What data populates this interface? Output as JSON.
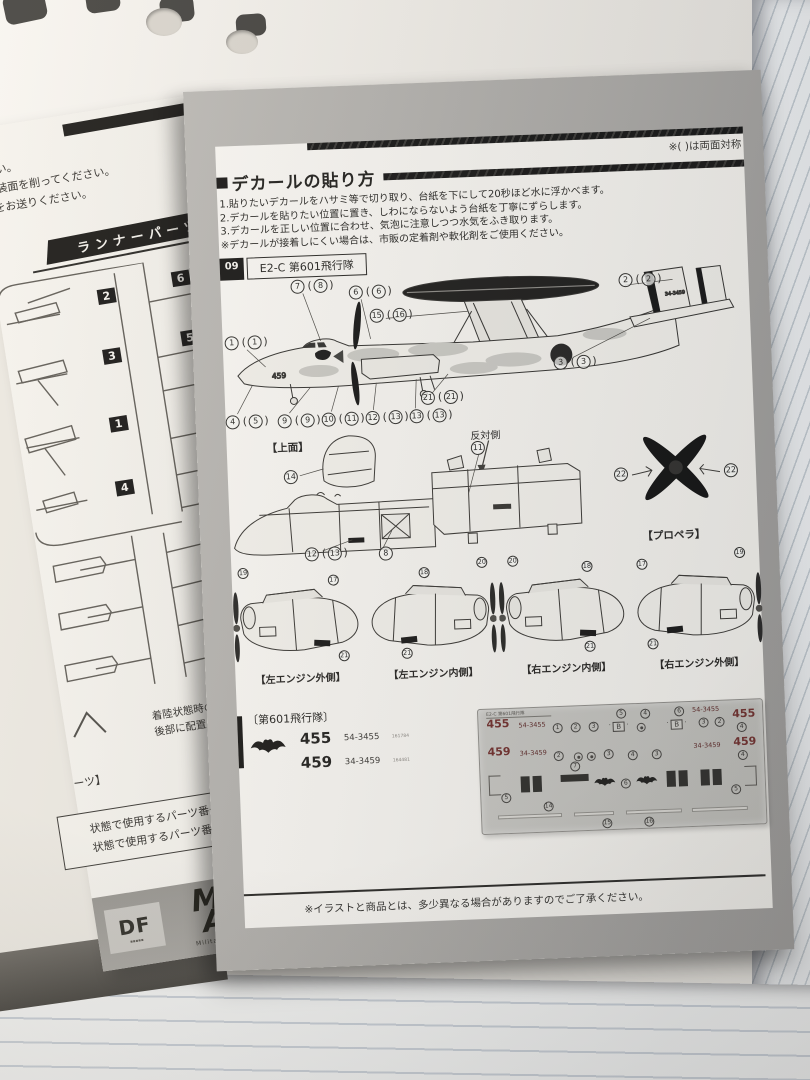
{
  "left_page": {
    "fragment_lines": [
      "さい。",
      "塗装面を削ってください。",
      "をお送りください。"
    ],
    "runner_header": "ランナーパーツ",
    "sprue1_tags": [
      "2",
      "6",
      "3",
      "5",
      "1",
      "4"
    ],
    "size_large": "大",
    "size_small": "小",
    "sprue2_tags": [
      "7",
      "8",
      "9",
      "10"
    ],
    "support_note": "着陸状態時の補助台座です。胴体後部に配置してください。",
    "partial_bracket": "ーツ】",
    "usage_lines": [
      "状態で使用するパーツ番号",
      "状態で使用するパーツ番号"
    ],
    "logos": {
      "partial": "DF",
      "mas_top": "M",
      "mas_bottom": "AS",
      "mas_sub": "Military Aircraft Series"
    }
  },
  "page": {
    "symmetry_note": "※( )は両面対称",
    "header": {
      "title": "デカールの貼り方"
    },
    "instructions": [
      "1.貼りたいデカールをハサミ等で切り取り、台紙を下にして20秒ほど水に浮かべます。",
      "2.デカールを貼りたい位置に置き、しわにならないよう台紙を丁寧にずらします。",
      "3.デカールを正しい位置に合わせ、気泡に注意しつつ水気をふき取ります。",
      "※デカールが接着しにくい場合は、市販の定着剤や軟化剤をご使用ください。"
    ],
    "variant": {
      "number": "09",
      "name": "E2-C 第601飛行隊"
    },
    "side_view": {
      "tail_code": "34-3459",
      "nose_code": "459",
      "callouts": {
        "c7": {
          "n": "7",
          "m": "8"
        },
        "c6": {
          "n": "6",
          "m": "6"
        },
        "c1": {
          "n": "1",
          "m": "1"
        },
        "c15": {
          "n": "15",
          "m": "16"
        },
        "c2": {
          "n": "2",
          "m": "2"
        },
        "c3": {
          "n": "3",
          "m": "3"
        },
        "c21": {
          "n": "21",
          "m": "21"
        },
        "c4": {
          "n": "4",
          "m": "5"
        },
        "c9": {
          "n": "9",
          "m": "9"
        },
        "c10": {
          "n": "10",
          "m": "11"
        },
        "c12": {
          "n": "12",
          "m": "13"
        },
        "c13": {
          "n": "13",
          "m": "13"
        }
      }
    },
    "top_view": {
      "label": "【上面】",
      "callout": "14"
    },
    "nose_detail": {
      "callout_a": {
        "n": "12",
        "m": "13"
      },
      "callout_b": "8"
    },
    "opposite": {
      "label": "反対側",
      "callout": "11"
    },
    "propeller": {
      "label": "【プロペラ】",
      "left": "22",
      "right": "22"
    },
    "engines": [
      {
        "label": "【左エンジン外側】",
        "callouts": [
          "19",
          "17",
          "21"
        ]
      },
      {
        "label": "【左エンジン内側】",
        "callouts": [
          "18",
          "20",
          "21"
        ]
      },
      {
        "label": "【右エンジン内側】",
        "callouts": [
          "20",
          "18",
          "21"
        ]
      },
      {
        "label": "【右エンジン外側】",
        "callouts": [
          "17",
          "19",
          "21"
        ]
      }
    ],
    "squadron": {
      "title": "〔第601飛行隊〕",
      "rows": [
        {
          "code": "455",
          "serial": "54-3455",
          "note": "161784"
        },
        {
          "code": "459",
          "serial": "34-3459",
          "note": "164481"
        }
      ]
    },
    "decal_sheet": {
      "corner_text": "E2-C 第601飛行隊",
      "row1": {
        "left_code": "455",
        "left_serial": "54-3455",
        "n1": "1",
        "n2": "2",
        "n3": "3",
        "n4": "5",
        "n5": "4",
        "n6": "6",
        "n7": "3",
        "n8": "2",
        "right_serial": "54-3455",
        "right_code": "455",
        "n9": "4"
      },
      "row2": {
        "left_code": "459",
        "left_serial": "34-3459",
        "n1": "2",
        "n2": "3",
        "n3": "4",
        "n4": "3",
        "right_serial": "34-3459",
        "right_code": "459",
        "n5": "4"
      },
      "row3": {
        "n1": "5",
        "n2": "7",
        "n3": "6",
        "n4": "5"
      },
      "row4": {
        "n1": "14",
        "n2": "15",
        "n3": "16"
      },
      "letter_b": "B"
    },
    "footer_note": "※イラストと商品とは、多少異なる場合がありますのでご了承ください。"
  }
}
